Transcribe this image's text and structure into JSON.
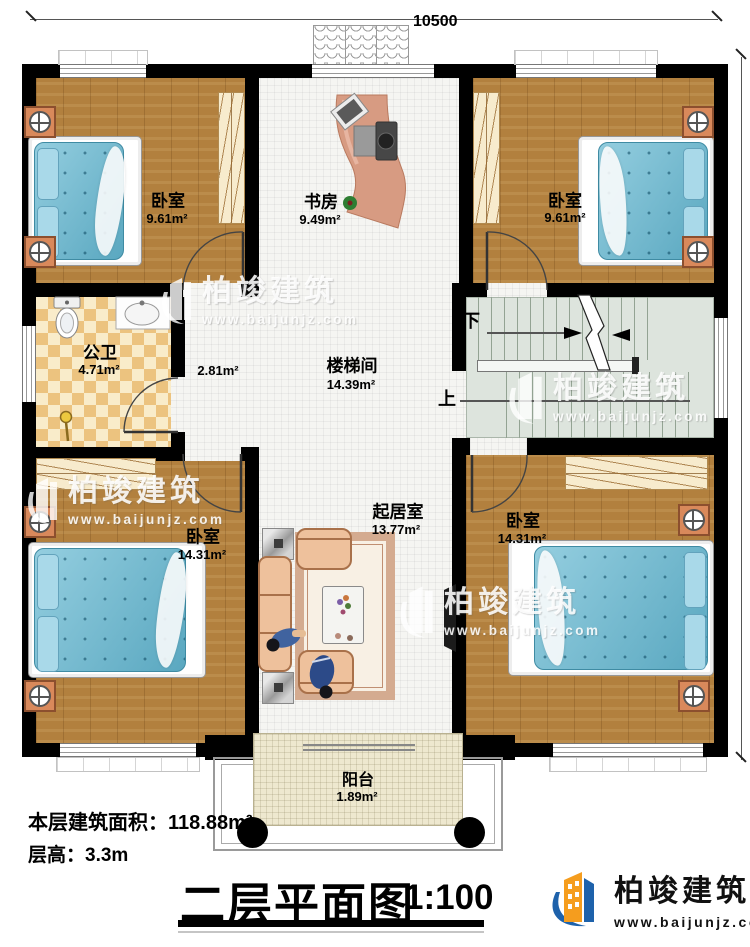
{
  "dimensions": {
    "top": "10500",
    "right": "11370"
  },
  "rooms": {
    "bedroom_tl": {
      "name": "卧室",
      "area": "9.61m²"
    },
    "study": {
      "name": "书房",
      "area": "9.49m²"
    },
    "bedroom_tr": {
      "name": "卧室",
      "area": "9.61m²"
    },
    "bathroom": {
      "name": "公卫",
      "area": "4.71m²"
    },
    "hall": {
      "area": "2.81m²"
    },
    "stairwell": {
      "name": "楼梯间",
      "area": "14.39m²"
    },
    "bedroom_bl": {
      "name": "卧室",
      "area": "14.31m²"
    },
    "living": {
      "name": "起居室",
      "area": "13.77m²"
    },
    "bedroom_br": {
      "name": "卧室",
      "area": "14.31m²"
    },
    "balcony": {
      "name": "阳台",
      "area": "1.89m²"
    }
  },
  "stairs": {
    "down": "下",
    "up": "上"
  },
  "footer": {
    "floor_area": "本层建筑面积：118.88m²",
    "floor_height": "层高：3.3m",
    "title": "二层平面图",
    "scale": "1:100"
  },
  "brand": {
    "name": "柏竣建筑",
    "url": "www.baijunjz.com"
  },
  "colors": {
    "wall": "#000000",
    "wood": "#b2803e",
    "mattress": "#66b9d2",
    "checker": "#ecc37f",
    "stair": "#dde4dd",
    "balcony_floor": "#eee8cf",
    "desk": "#d79b82",
    "sofa": "#eec19c",
    "logo_orange": "#f59d1e",
    "logo_blue": "#1e62ab"
  }
}
